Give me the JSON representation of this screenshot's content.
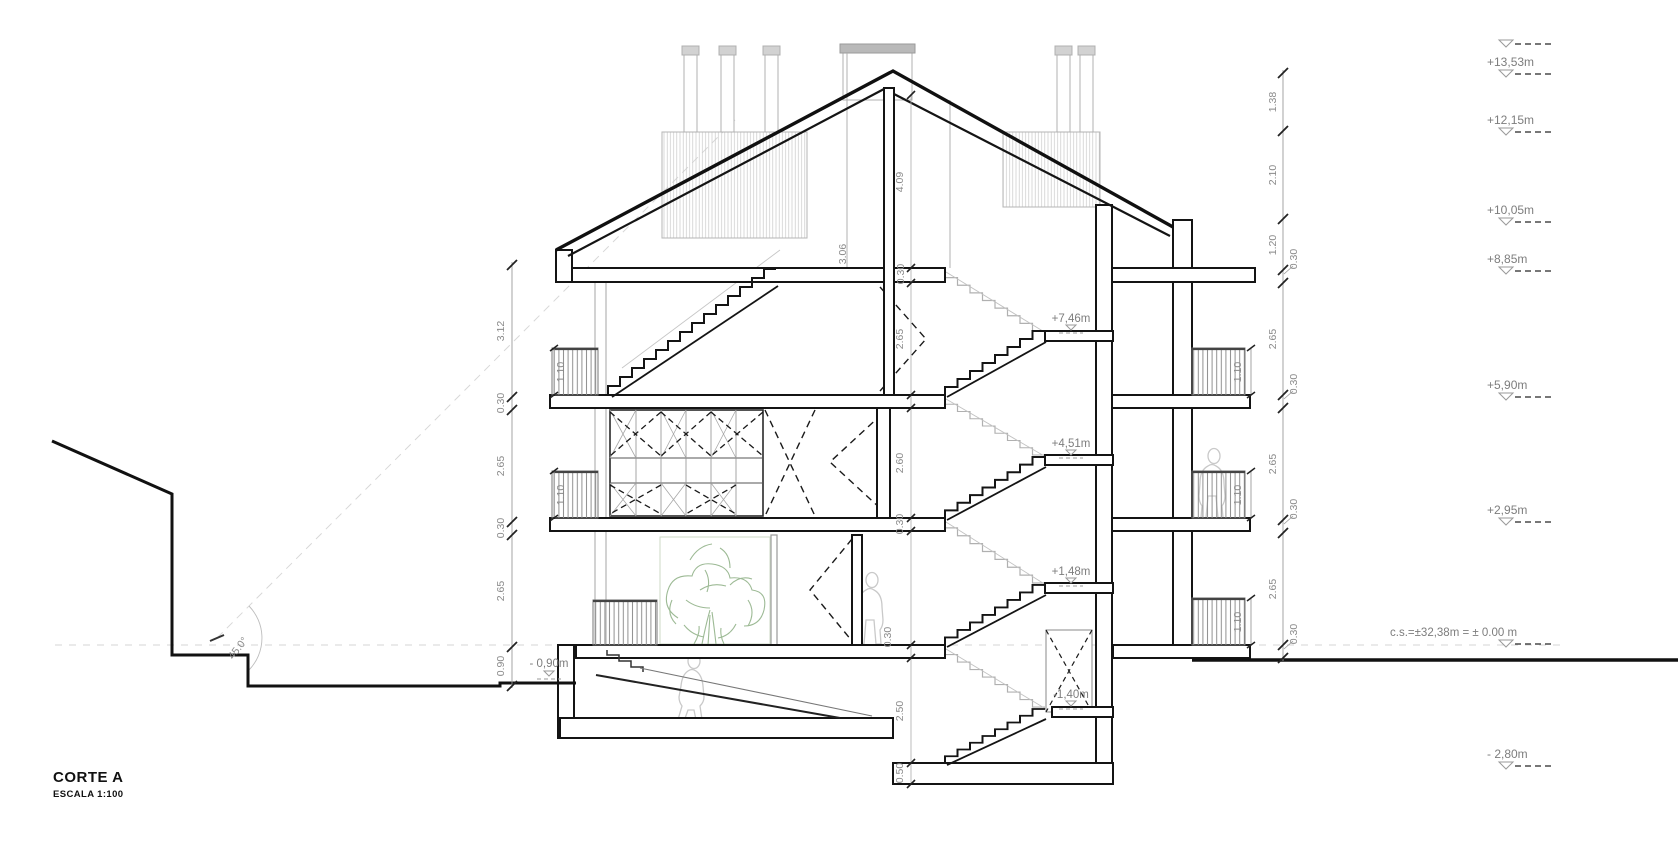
{
  "title_block": {
    "title": "CORTE A",
    "scale": "ESCALA 1:100"
  },
  "levels": {
    "right": [
      "+13,53m",
      "+12,15m",
      "+10,05m",
      "+8,85m",
      "+5,90m",
      "+2,95m",
      "- 2,80m"
    ],
    "ground_note": "c.s.=±32,38m  =  ± 0.00 m",
    "street_left": "- 0,90m",
    "stair_landings": [
      "+7,46m",
      "+4,51m",
      "+1,48m",
      "-1,40m"
    ]
  },
  "dimensions": {
    "left_chain": [
      "3.12",
      "0.30",
      "2.65",
      "0.30",
      "2.65",
      "0.90"
    ],
    "right_chain": [
      "1.38",
      "2.10",
      "1.20",
      "0.30",
      "2.65",
      "0.30",
      "2.65",
      "0.30",
      "2.65",
      "0.30"
    ],
    "center_chain": [
      "4.09",
      "0.30",
      "2.65",
      "2.60",
      "0.30",
      "0.30",
      "2.50",
      "0.50"
    ],
    "attic_dim": "3.06",
    "balcony_left": [
      "1.10",
      "1.10"
    ],
    "balcony_right": [
      "1.10",
      "1.10",
      "1.10"
    ],
    "angle": "45.0°"
  },
  "colors": {
    "ink": "#141414",
    "dim_gray": "#8a8a8a",
    "label_gray": "#7d7d7d",
    "beyond_gray": "#c4c4c4",
    "tree_green": "#9cba94"
  }
}
